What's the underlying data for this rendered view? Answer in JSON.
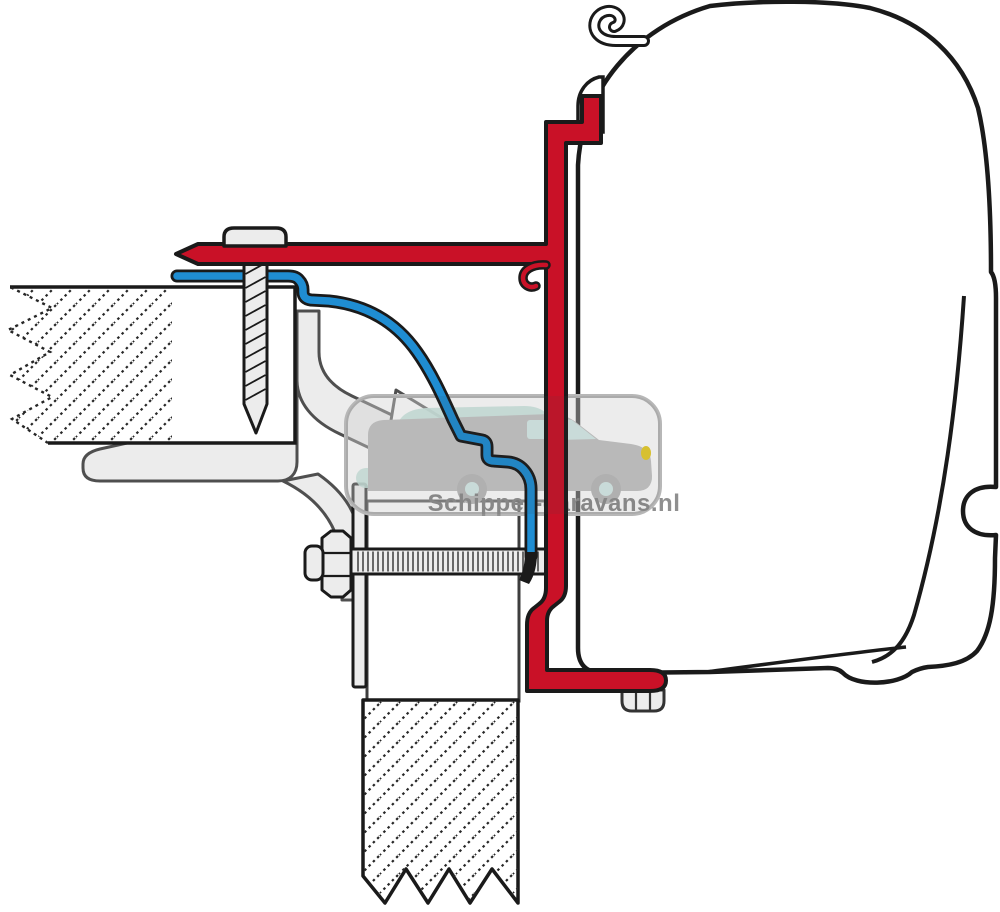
{
  "watermark": {
    "text": "Schipper-caravans.nl",
    "frame_color": "#b7b7b7",
    "van_icon": "campervan-silhouette-icon",
    "caravan_icon": "caravan-silhouette-icon"
  },
  "palette": {
    "outline": "#1a1a1a",
    "red": "#c91127",
    "blue": "#1f8dd2",
    "part-fill": "#ececec",
    "part-outline": "#4f4f4f",
    "white": "#ffffff",
    "hatch": "#262626",
    "wm-gray": "#b7b7b7",
    "wm-text": "#8f8f8f",
    "wm-van": "#c7c7c7",
    "wm-wheel": "#bdbdbd",
    "wm-teal": "#cfe8e2",
    "wm-window": "#d9edea",
    "wm-headlight": "#e8cf2e"
  },
  "canvas": {
    "width": 1000,
    "height": 912
  }
}
